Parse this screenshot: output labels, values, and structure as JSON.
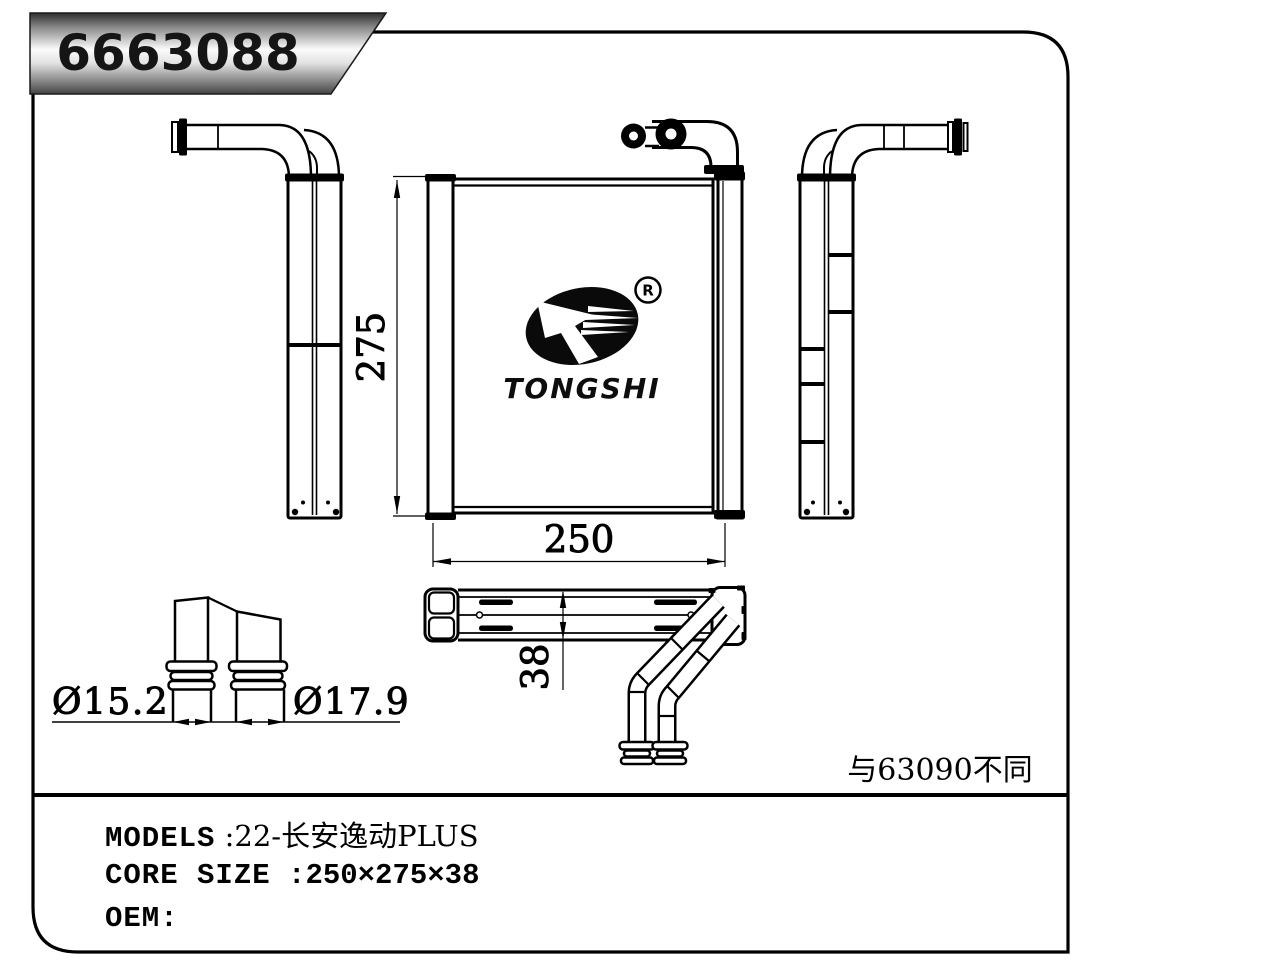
{
  "banner": {
    "part_number": "6663088"
  },
  "logo": {
    "brand": "TONGSHI",
    "registered_mark": "R"
  },
  "dimensions": {
    "height": "275",
    "width": "250",
    "depth": "38",
    "pipe_diameter_small": "Ø15.2",
    "pipe_diameter_large": "Ø17.9"
  },
  "note": {
    "text": "与63090不同"
  },
  "info": {
    "rows": [
      {
        "label": "MODELS",
        "value": " :22-长安逸动PLUS"
      },
      {
        "label": "CORE SIZE",
        "value": " :250×275×38"
      },
      {
        "label": "OEM:",
        "value": ""
      }
    ]
  },
  "colors": {
    "line": "#000000",
    "background": "#ffffff",
    "banner_gradient_top": "#2f2f2f",
    "banner_gradient_middle": "#fbfbfb",
    "banner_gradient_bottom": "#454545",
    "text": "#111111"
  }
}
